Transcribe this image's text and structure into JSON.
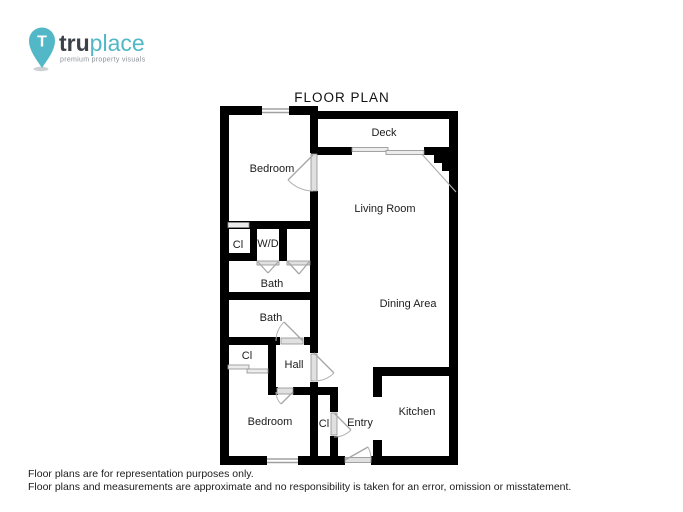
{
  "logo": {
    "brand_bold": "tru",
    "brand_light": "place",
    "pin_letter": "T",
    "tagline": "premium property visuals",
    "colors": {
      "teal": "#52b7c6",
      "dark": "#3b4147",
      "tagline_gray": "#8d9297"
    }
  },
  "title": "FLOOR PLAN",
  "rooms": {
    "deck": "Deck",
    "bedroom_top": "Bedroom",
    "living_room": "Living Room",
    "closet_top": "Cl",
    "washer_dryer": "W/D",
    "bath_upper": "Bath",
    "dining_area": "Dining Area",
    "bath_lower": "Bath",
    "closet_bedroom": "Cl",
    "hall": "Hall",
    "bedroom_bottom": "Bedroom",
    "closet_entry": "Cl",
    "entry": "Entry",
    "kitchen": "Kitchen"
  },
  "disclaimer": {
    "line1": "Floor plans are for representation purposes only.",
    "line2": "Floor plans and measurements are approximate and no responsibility is taken for an error, omission or misstatement."
  }
}
